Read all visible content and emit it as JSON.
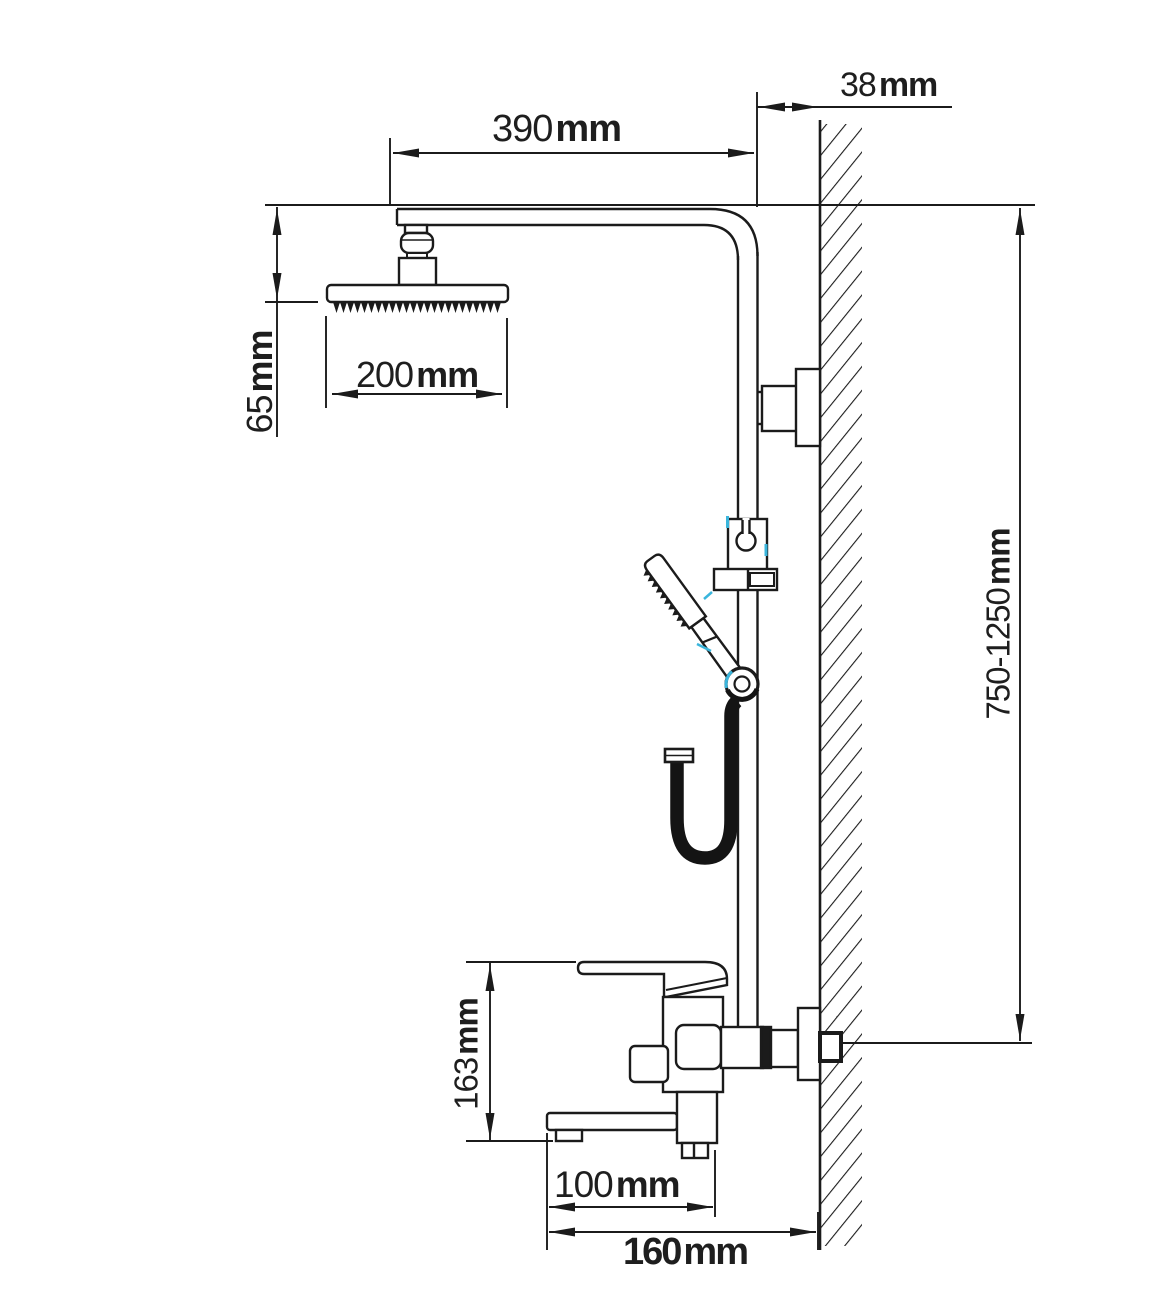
{
  "figure": {
    "kind": "technical installation drawing",
    "background": "#ffffff",
    "line_color": "#1b1b1b",
    "accent_color": "#3ab5dc"
  },
  "dimensions": {
    "wall_offset": {
      "value": "38",
      "unit": "mm"
    },
    "arm_reach": {
      "value": "390",
      "unit": "mm"
    },
    "head_drop": {
      "value": "65",
      "unit": "mm"
    },
    "head_width": {
      "value": "200",
      "unit": "mm"
    },
    "riser_height": {
      "value": "750-1250",
      "unit": "mm"
    },
    "mixer_height": {
      "value": "163",
      "unit": "mm"
    },
    "spout_reach": {
      "value": "100",
      "unit": "mm"
    },
    "overall_reach": {
      "value": "160",
      "unit": "mm"
    }
  }
}
